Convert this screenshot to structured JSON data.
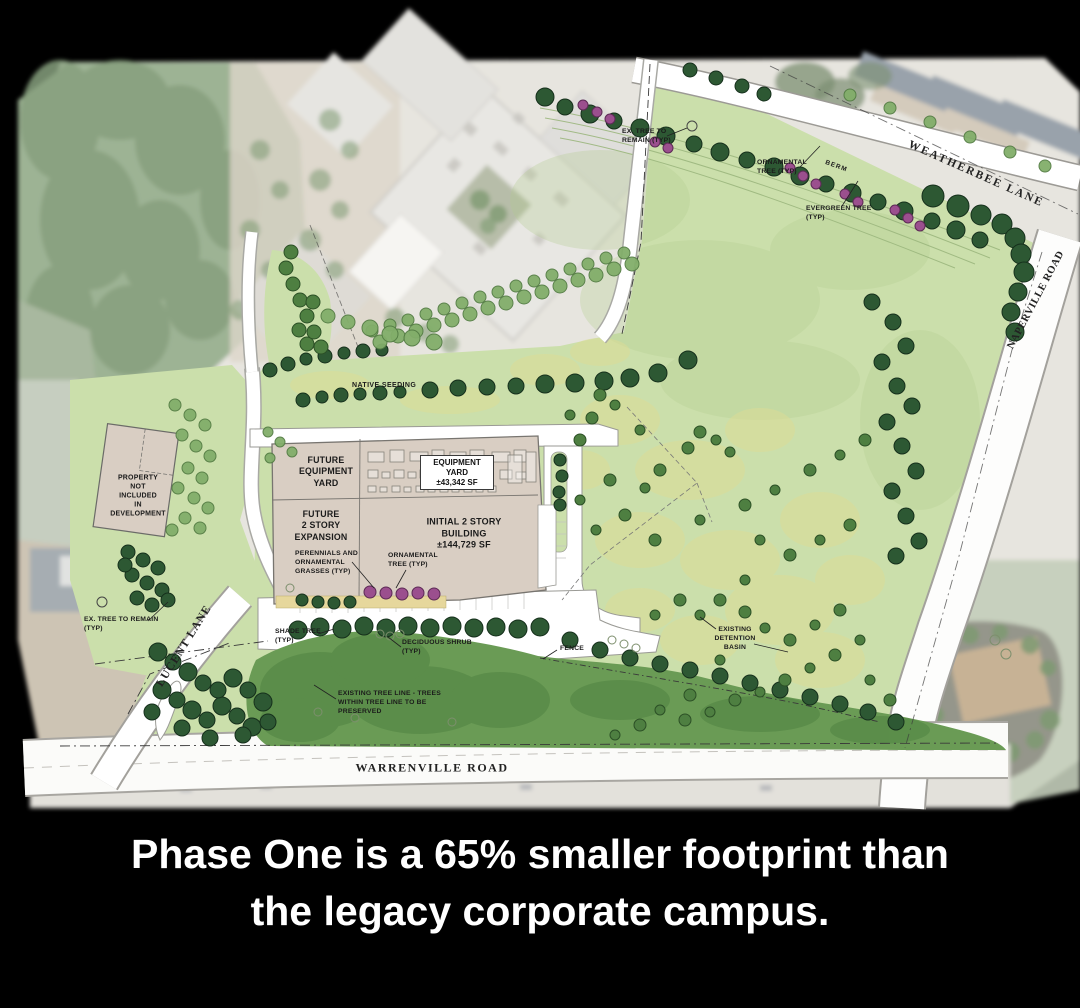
{
  "caption": {
    "line1": "Phase One is a 65% smaller footprint than",
    "line2": "the legacy corporate campus.",
    "color": "#ffffff"
  },
  "site_plan": {
    "roads": {
      "weatherbee": "WEATHERBEE LANE",
      "naperville": "NAPERVILLE ROAD",
      "lucent": "LUCENT LANE",
      "warrenville": "WARRENVILLE ROAD"
    },
    "annotations": {
      "ex_tree_top": "EX. TREE TO\nREMAIN (TYP)",
      "ornamental_tree_ne": "ORNAMENTAL\nTREE (TYP)",
      "berm": "BERM",
      "evergreen_tree": "EVERGREEN TREE\n(TYP)",
      "native_seeding": "NATIVE SEEDING",
      "future_equipment_yard": "FUTURE\nEQUIPMENT\nYARD",
      "equipment_yard": "EQUIPMENT\nYARD\n±43,342 SF",
      "future_expansion": "FUTURE\n2 STORY\nEXPANSION",
      "initial_building": "INITIAL 2 STORY\nBUILDING\n±144,729 SF",
      "perennials": "PERENNIALS AND\nORNAMENTAL\nGRASSES (TYP)",
      "ornamental_tree_s": "ORNAMENTAL\nTREE (TYP)",
      "property_not_included": "PROPERTY\nNOT\nINCLUDED\nIN\nDEVELOPMENT",
      "ex_tree_sw": "EX. TREE TO REMAIN\n(TYP)",
      "shade_tree": "SHADE TREE\n(TYP)",
      "deciduous_shrub": "DECIDUOUS SHRUB\n(TYP)",
      "fence": "FENCE",
      "existing_tree_line": "EXISTING TREE LINE - TREES\nWITHIN TREE LINE TO BE\nPRESERVED",
      "detention_basin": "EXISTING\nDETENTION\nBASIN"
    },
    "colors": {
      "field_green": "#cbdfab",
      "tree_mass_green": "#6a9b55",
      "tree_dark": "#2d5833",
      "tree_dark_stroke": "#16301c",
      "tree_med": "#4e7f41",
      "tree_med_stroke": "#2c5026",
      "tree_light": "#82ae6a",
      "tree_light_stroke": "#547d44",
      "tree_purple": "#9b4f8e",
      "tree_purple_stroke": "#5c2a55",
      "tree_washed": "#7e9a72",
      "building_tan": "#d9cec3",
      "basin_yellow": "#dcdc96",
      "road_white": "#ffffff",
      "caption_white": "#ffffff",
      "shrub_outline": "#7d8f6d"
    }
  }
}
